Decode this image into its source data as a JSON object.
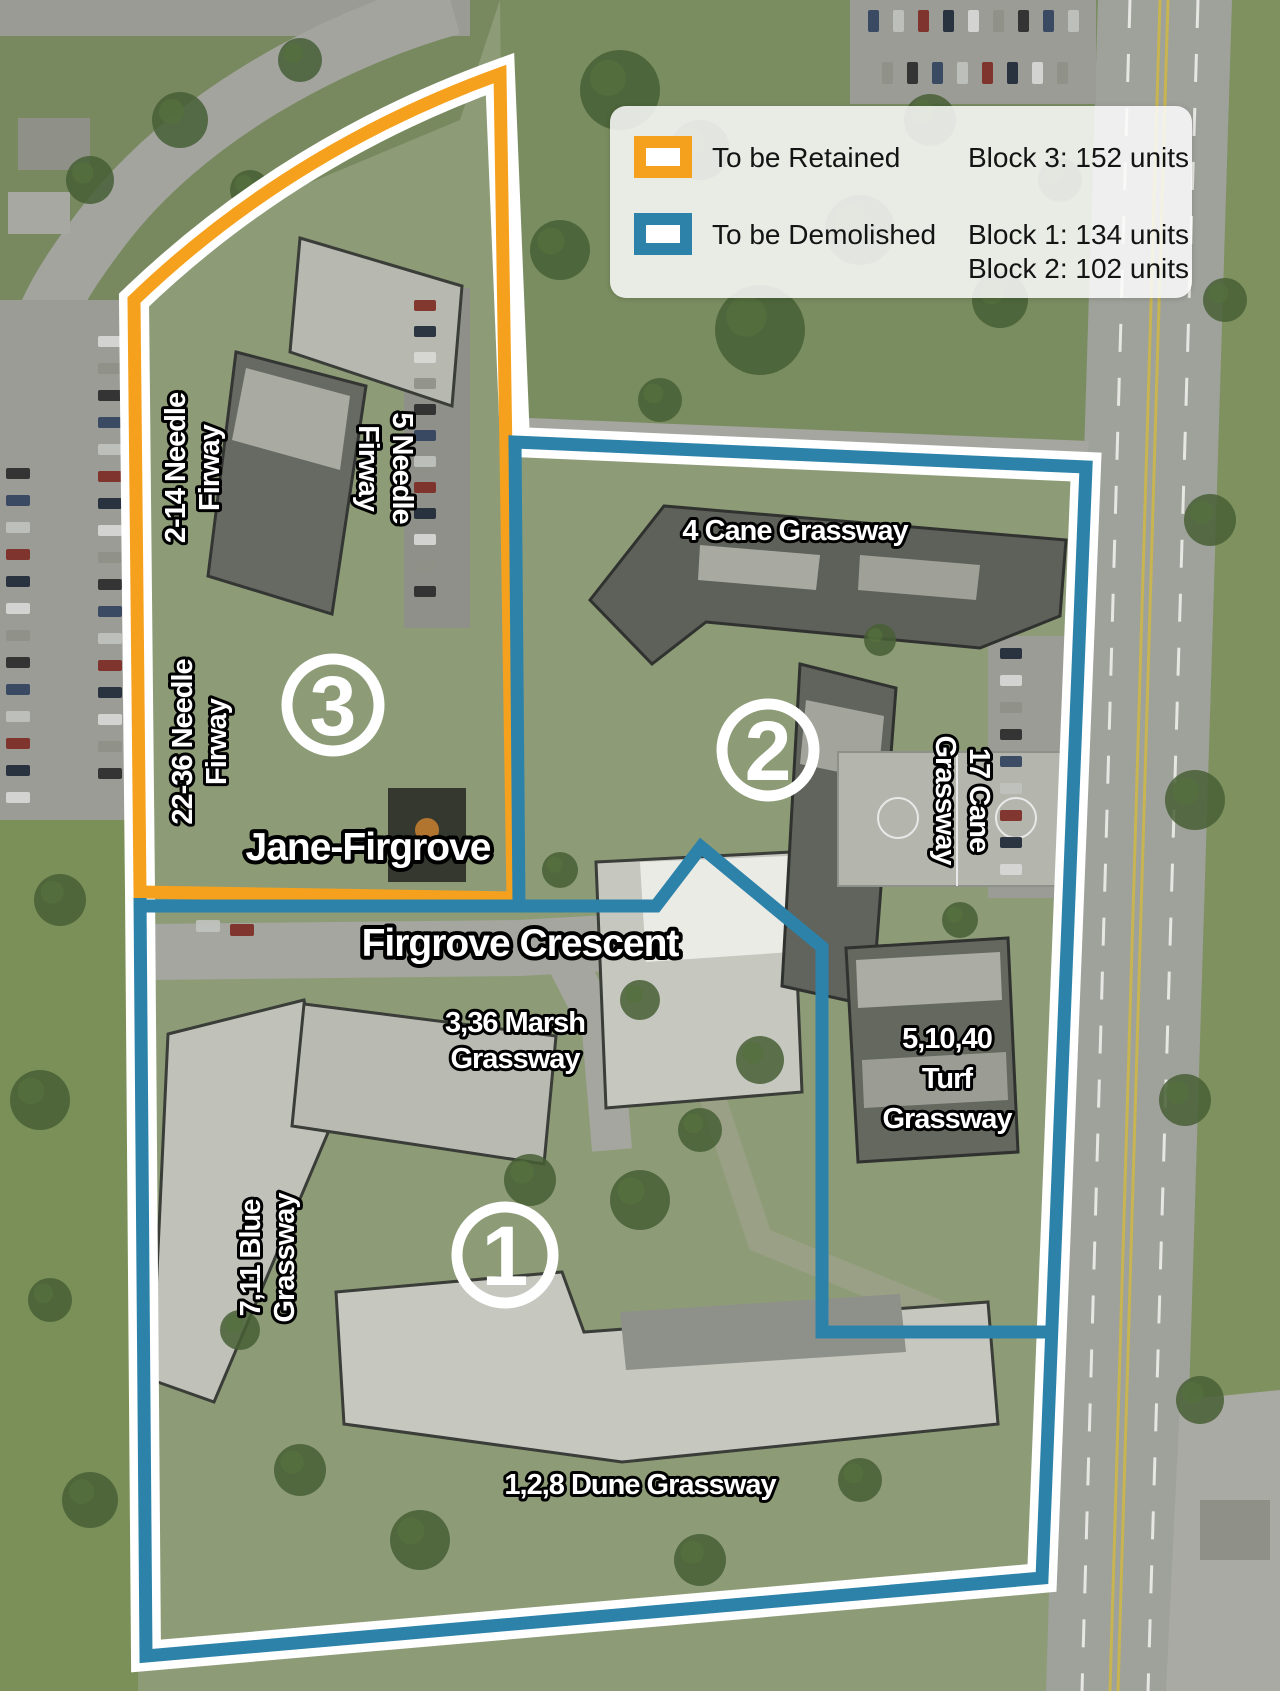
{
  "legend": {
    "retained": {
      "label": "To be Retained",
      "units": [
        "Block 3: 152 units"
      ]
    },
    "demolished": {
      "label": "To be Demolished",
      "units": [
        "Block 1: 134 units",
        "Block 2: 102 units"
      ]
    }
  },
  "colors": {
    "retained": "#F5A11E",
    "demolished": "#2D82AA"
  },
  "map_labels": {
    "needle_2_14_line1": "2-14 Needle",
    "needle_2_14_line2": "Firway",
    "needle_5_line1": "5 Needle",
    "needle_5_line2": "Firway",
    "needle_22_36_line1": "22-36 Needle",
    "needle_22_36_line2": "Firway",
    "jane_firgrove": "Jane-Firgrove",
    "cane_4": "4 Cane Grassway",
    "cane_17_line1": "17 Cane",
    "cane_17_line2": "Grassway",
    "firgrove_crescent": "Firgrove Crescent",
    "marsh_line1": "3,36 Marsh",
    "marsh_line2": "Grassway",
    "turf_line1": "5,10,40",
    "turf_line2": "Turf",
    "turf_line3": "Grassway",
    "blue_line1": "7,11 Blue",
    "blue_line2": "Grassway",
    "dune": "1,2,8 Dune Grassway",
    "badge_block1": "1",
    "badge_block2": "2",
    "badge_block3": "3"
  }
}
